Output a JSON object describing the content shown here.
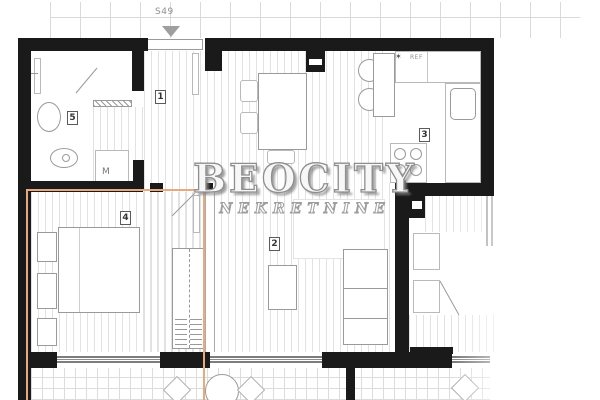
{
  "watermark": {
    "brand": "BEOCITY",
    "subtitle": "NEKRETNINE"
  },
  "entrance": {
    "unit_label": "S49"
  },
  "rooms": [
    {
      "name": "hallway",
      "number": "1"
    },
    {
      "name": "living-room",
      "number": "2"
    },
    {
      "name": "kitchen",
      "number": "3"
    },
    {
      "name": "bedroom",
      "number": "4"
    },
    {
      "name": "bathroom",
      "number": "5"
    }
  ],
  "labels": {
    "washing_machine": "M",
    "fridge": "REF",
    "fridge_star": "✶"
  },
  "colors": {
    "wall": "#1a1a1a",
    "highlight": "#eaa87e",
    "hatch": "#e2e2e2"
  }
}
